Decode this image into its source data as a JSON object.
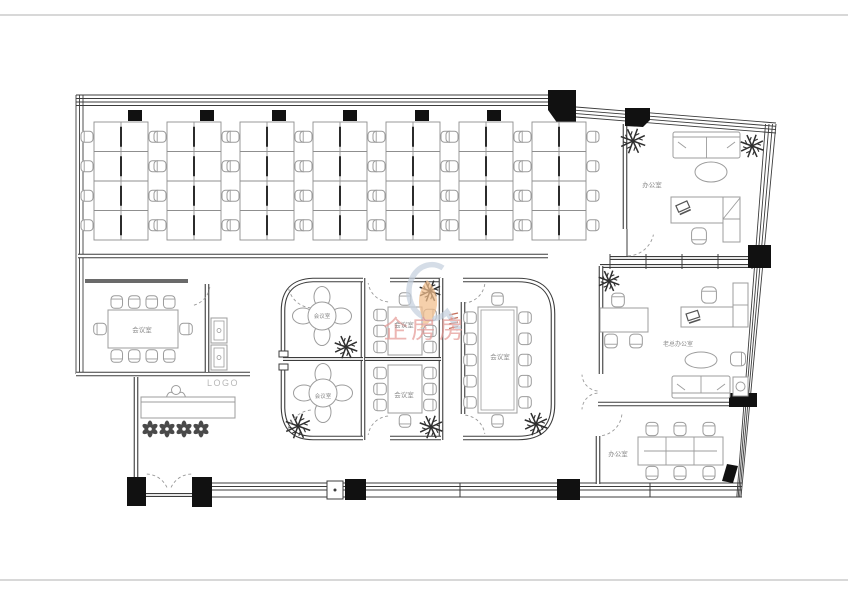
{
  "plan": {
    "type": "office-floor-plan",
    "desk_clusters": 7,
    "workstations": 56
  },
  "logo_label": "LOGO",
  "watermark": {
    "text": "企房房",
    "swoosh_color": "#c6d1de",
    "flame_color": "#f2be8c",
    "text_color": "#e59a97"
  },
  "rooms": [
    {
      "id": "meeting-room-left",
      "label": "会议室",
      "seats": 10
    },
    {
      "id": "meeting-room-round-top",
      "label": "会议室",
      "seats": 4
    },
    {
      "id": "meeting-room-round-bottom",
      "label": "会议室",
      "seats": 4
    },
    {
      "id": "meeting-room-mid-top",
      "label": "会议室",
      "seats": 7
    },
    {
      "id": "meeting-room-mid-bottom",
      "label": "会议室",
      "seats": 7
    },
    {
      "id": "meeting-room-large",
      "label": "会议室",
      "seats": 12
    },
    {
      "id": "office-top-right",
      "label": "办公室"
    },
    {
      "id": "ceo-office",
      "label": "老总办公室"
    },
    {
      "id": "office-bottom-right",
      "label": "办公室",
      "seats": 6
    }
  ],
  "colors": {
    "wall": "#3c3c3c",
    "furniture": "#9c9c9c",
    "column": "#111111",
    "label_text": "#8a8a8a",
    "logo_text": "#b8b8b8",
    "page_border": "#b0b0b0"
  }
}
